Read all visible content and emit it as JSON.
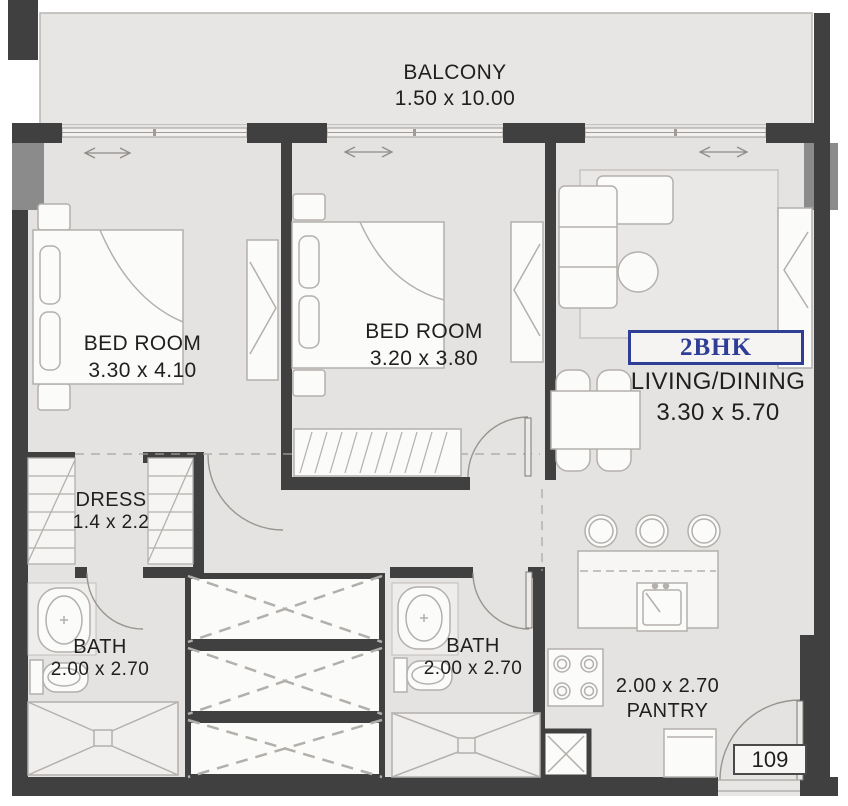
{
  "plan": {
    "title": "2BHK floor plan",
    "unit_type": "2BHK",
    "unit_number": "109",
    "rooms": {
      "balcony": {
        "label": "BALCONY",
        "dims": "1.50 x 10.00"
      },
      "bedroom1": {
        "label": "BED ROOM",
        "dims": "3.30 x 4.10"
      },
      "bedroom2": {
        "label": "BED ROOM",
        "dims": "3.20 x 3.80"
      },
      "living_dining": {
        "label": "LIVING/DINING",
        "dims": "3.30 x 5.70"
      },
      "dress": {
        "label": "DRESS",
        "dims": "1.4 x 2.2"
      },
      "bath1": {
        "label": "BATH",
        "dims": "2.00 x 2.70"
      },
      "bath2": {
        "label": "BATH",
        "dims": "2.00 x 2.70"
      },
      "pantry": {
        "label": "PANTRY",
        "dims": "2.00 x 2.70"
      }
    },
    "colors": {
      "wall": "#404040",
      "column": "#8b8b8b",
      "floor": "#e5e3e1",
      "balcony_floor": "#e8e6e4",
      "furniture_fill": "#fbfbfa",
      "furniture_stroke": "#b3b0ad",
      "accent_blue": "#2e3d96",
      "text": "#1f1f1f"
    }
  }
}
